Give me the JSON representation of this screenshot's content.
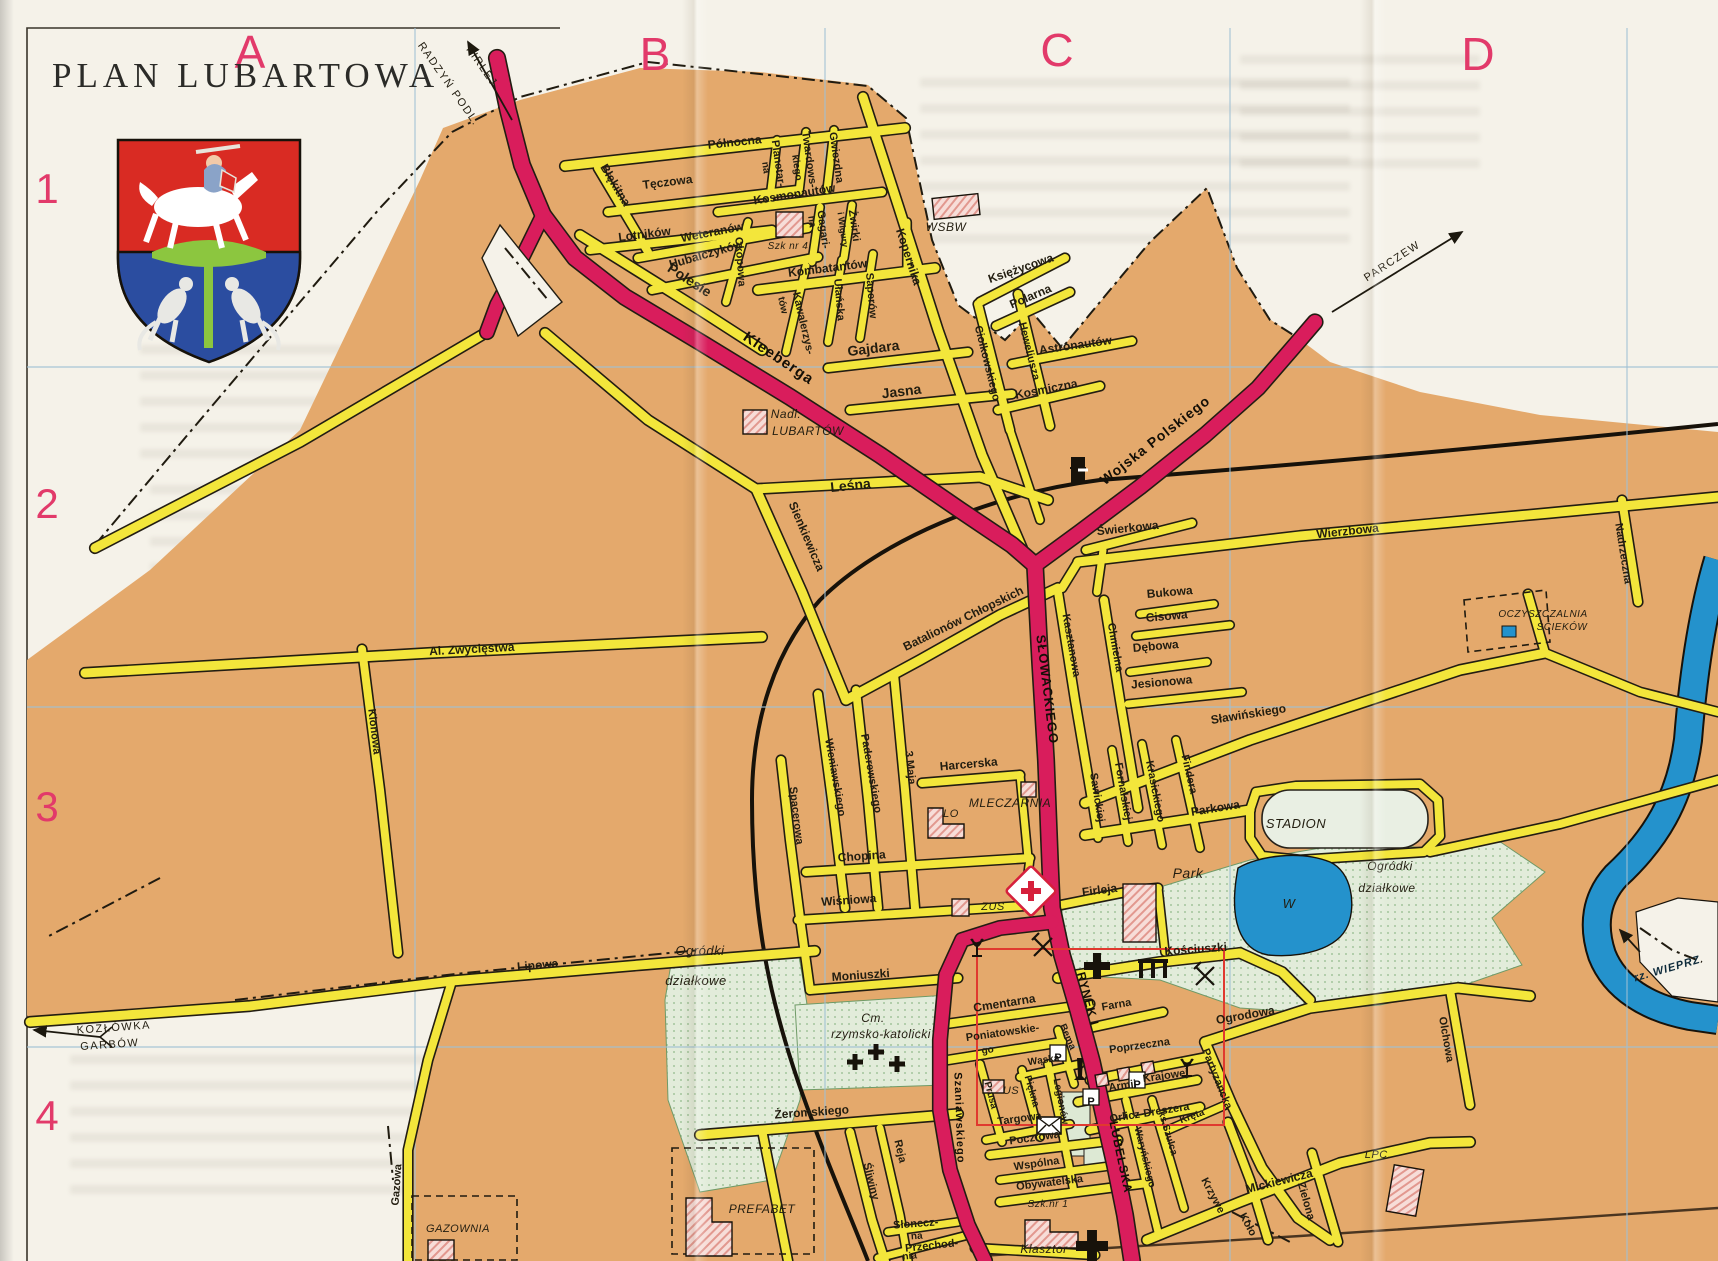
{
  "title": "PLAN LUBARTOWA",
  "grid": {
    "columns": [
      "A",
      "B",
      "C",
      "D"
    ],
    "rows": [
      "1",
      "2",
      "3",
      "4"
    ]
  },
  "colors": {
    "paper": "#f5f2e9",
    "urban_tan": "#e4a96c",
    "road_yellow": "#f3e63b",
    "road_major": "#d91d5c",
    "water": "#2492cc",
    "green_area": "#e2ecda",
    "grid_blue": "#9fc0d4",
    "grid_letter": "#e23a6a",
    "inset_red": "#e0392f",
    "building_pink": "#f7ddd8"
  },
  "map": {
    "labels": [
      {
        "t": "A",
        "x": 250,
        "y": 68,
        "c": "grid",
        "s": 46
      },
      {
        "t": "B",
        "x": 655,
        "y": 70,
        "c": "grid",
        "s": 46
      },
      {
        "t": "C",
        "x": 1057,
        "y": 66,
        "c": "grid",
        "s": 46
      },
      {
        "t": "D",
        "x": 1478,
        "y": 70,
        "c": "grid",
        "s": 46
      },
      {
        "t": "1",
        "x": 47,
        "y": 203,
        "c": "grid",
        "s": 42
      },
      {
        "t": "2",
        "x": 47,
        "y": 518,
        "c": "grid",
        "s": 42
      },
      {
        "t": "3",
        "x": 47,
        "y": 821,
        "c": "grid",
        "s": 42
      },
      {
        "t": "4",
        "x": 47,
        "y": 1130,
        "c": "grid",
        "s": 42
      },
      {
        "t": "RADZYŃ PODL.",
        "x": 446,
        "y": 86,
        "r": 55,
        "c": "dir",
        "s": 11
      },
      {
        "t": "FIRLEJ",
        "x": 479,
        "y": 68,
        "r": 55,
        "c": "dir",
        "s": 11
      },
      {
        "t": "PARCZEW",
        "x": 1394,
        "y": 264,
        "r": -33,
        "c": "dir",
        "s": 11
      },
      {
        "t": "KOZŁÓWKA",
        "x": 114,
        "y": 1031,
        "r": -4,
        "c": "dir",
        "s": 11
      },
      {
        "t": "GARBÓW",
        "x": 110,
        "y": 1048,
        "r": -4,
        "c": "dir",
        "s": 11
      },
      {
        "t": "rz. WIEPRZ",
        "x": 1668,
        "y": 972,
        "r": -16,
        "c": "wat",
        "s": 11
      },
      {
        "t": "Północna",
        "x": 735,
        "y": 146,
        "r": -6
      },
      {
        "t": "Błękitna",
        "x": 612,
        "y": 187,
        "r": 59
      },
      {
        "t": "Tęczowa",
        "x": 668,
        "y": 186,
        "r": -7
      },
      {
        "t": "Lotników",
        "x": 645,
        "y": 238,
        "r": -7
      },
      {
        "t": "Kosmonautów",
        "x": 795,
        "y": 198,
        "r": -9
      },
      {
        "t": "Planetar-",
        "x": 775,
        "y": 164,
        "r": 82,
        "s": 11
      },
      {
        "t": "na",
        "x": 763,
        "y": 168,
        "r": 82,
        "s": 10
      },
      {
        "t": "Twardows-",
        "x": 806,
        "y": 160,
        "r": 82,
        "s": 11
      },
      {
        "t": "kiego",
        "x": 794,
        "y": 168,
        "r": 82,
        "s": 10
      },
      {
        "t": "Gwiezdna",
        "x": 833,
        "y": 158,
        "r": 82,
        "s": 11
      },
      {
        "t": "Żwirki",
        "x": 851,
        "y": 226,
        "r": 82,
        "s": 11
      },
      {
        "t": "i Wigury",
        "x": 840,
        "y": 230,
        "r": 82,
        "s": 9
      },
      {
        "t": "Gagari-",
        "x": 820,
        "y": 230,
        "r": 82,
        "s": 11
      },
      {
        "t": "na",
        "x": 809,
        "y": 222,
        "r": 82,
        "s": 10
      },
      {
        "t": "Kopernika",
        "x": 905,
        "y": 258,
        "r": 72
      },
      {
        "t": "Okopowa",
        "x": 737,
        "y": 262,
        "r": 86,
        "s": 11
      },
      {
        "t": "Weteranów",
        "x": 713,
        "y": 236,
        "r": -11
      },
      {
        "t": "Hubalczyków",
        "x": 707,
        "y": 258,
        "r": -16
      },
      {
        "t": "Polesie",
        "x": 687,
        "y": 284,
        "r": 33,
        "s": 14
      },
      {
        "t": "Kawalerzys-",
        "x": 800,
        "y": 324,
        "r": 77,
        "s": 11
      },
      {
        "t": "tów",
        "x": 780,
        "y": 306,
        "r": 77,
        "s": 10
      },
      {
        "t": "Ułańska",
        "x": 836,
        "y": 300,
        "r": 85,
        "s": 11
      },
      {
        "t": "Saperów",
        "x": 868,
        "y": 296,
        "r": 85,
        "s": 11
      },
      {
        "t": "Kombatantów",
        "x": 828,
        "y": 272,
        "r": -7
      },
      {
        "t": "Gajdara",
        "x": 874,
        "y": 353,
        "r": -7,
        "s": 14
      },
      {
        "t": "Jasna",
        "x": 902,
        "y": 396,
        "r": -7,
        "s": 14
      },
      {
        "t": "Kleeberga",
        "x": 776,
        "y": 362,
        "r": 34,
        "s": 15,
        "c": "mj"
      },
      {
        "t": "Księżycowa",
        "x": 1022,
        "y": 272,
        "r": -19
      },
      {
        "t": "Polarna",
        "x": 1032,
        "y": 300,
        "r": -23
      },
      {
        "t": "Ciołkowskiego",
        "x": 984,
        "y": 364,
        "r": 76,
        "s": 11
      },
      {
        "t": "Heweliusza",
        "x": 1026,
        "y": 352,
        "r": 76,
        "s": 11
      },
      {
        "t": "Astronautów",
        "x": 1076,
        "y": 349,
        "r": -8
      },
      {
        "t": "Kosmiczna",
        "x": 1047,
        "y": 393,
        "r": -11
      },
      {
        "t": "Wojska Polskiego",
        "x": 1158,
        "y": 444,
        "r": -38,
        "s": 14,
        "c": "mj"
      },
      {
        "t": "Leśna",
        "x": 851,
        "y": 490,
        "r": -6,
        "s": 14
      },
      {
        "t": "Sienkiewicza",
        "x": 803,
        "y": 538,
        "r": 67
      },
      {
        "t": "Świerkowa",
        "x": 1128,
        "y": 532,
        "r": -6
      },
      {
        "t": "Wierzbowa",
        "x": 1348,
        "y": 535,
        "r": -6
      },
      {
        "t": "Nadrzeczna",
        "x": 1620,
        "y": 554,
        "r": 81,
        "s": 11
      },
      {
        "t": "Kasztanowa",
        "x": 1068,
        "y": 646,
        "r": 80,
        "s": 11
      },
      {
        "t": "Chmielna",
        "x": 1112,
        "y": 648,
        "r": 80,
        "s": 11
      },
      {
        "t": "Bukowa",
        "x": 1170,
        "y": 596,
        "r": -5
      },
      {
        "t": "Cisowa",
        "x": 1167,
        "y": 620,
        "r": -5
      },
      {
        "t": "Dębowa",
        "x": 1156,
        "y": 650,
        "r": -5
      },
      {
        "t": "Jesionowa",
        "x": 1162,
        "y": 686,
        "r": -5
      },
      {
        "t": "Sławińskiego",
        "x": 1249,
        "y": 718,
        "r": -9
      },
      {
        "t": "Batalionów Chłopskich",
        "x": 965,
        "y": 622,
        "r": -26
      },
      {
        "t": "SŁOWACKIEGO",
        "x": 1043,
        "y": 690,
        "r": 83,
        "s": 13,
        "c": "mj"
      },
      {
        "t": "Spacerowa",
        "x": 793,
        "y": 816,
        "r": 83,
        "s": 11
      },
      {
        "t": "Wieniawskiego",
        "x": 832,
        "y": 778,
        "r": 80,
        "s": 11
      },
      {
        "t": "Paderewskiego",
        "x": 868,
        "y": 774,
        "r": 80,
        "s": 11
      },
      {
        "t": "3 Maja",
        "x": 907,
        "y": 768,
        "r": 84,
        "s": 11
      },
      {
        "t": "Harcerska",
        "x": 969,
        "y": 768,
        "r": -5
      },
      {
        "t": "Chopina",
        "x": 862,
        "y": 860,
        "r": -4
      },
      {
        "t": "Wiśniowa",
        "x": 849,
        "y": 904,
        "r": -4
      },
      {
        "t": "Moniuszki",
        "x": 861,
        "y": 979,
        "r": -4
      },
      {
        "t": "Sawickiej",
        "x": 1094,
        "y": 798,
        "r": 81,
        "s": 11
      },
      {
        "t": "Fornalskiej",
        "x": 1120,
        "y": 792,
        "r": 80,
        "s": 11
      },
      {
        "t": "Krasickiego",
        "x": 1152,
        "y": 792,
        "r": 79,
        "s": 11
      },
      {
        "t": "Findera",
        "x": 1186,
        "y": 775,
        "r": 77,
        "s": 11
      },
      {
        "t": "Parkowa",
        "x": 1216,
        "y": 812,
        "r": -9
      },
      {
        "t": "Firleja",
        "x": 1100,
        "y": 894,
        "r": -7
      },
      {
        "t": "Kościuszki",
        "x": 1196,
        "y": 953,
        "r": -4
      },
      {
        "t": "Ogrodowa",
        "x": 1246,
        "y": 1019,
        "r": -10
      },
      {
        "t": "Olchowa",
        "x": 1443,
        "y": 1040,
        "r": 80,
        "s": 11
      },
      {
        "t": "Partyzancka",
        "x": 1214,
        "y": 1080,
        "r": 68,
        "s": 11
      },
      {
        "t": "Armii",
        "x": 1123,
        "y": 1089,
        "r": -8,
        "s": 11
      },
      {
        "t": "Krajowej",
        "x": 1166,
        "y": 1079,
        "r": -8,
        "s": 11
      },
      {
        "t": "Orlicz-Dreszera",
        "x": 1150,
        "y": 1116,
        "r": -9,
        "s": 11
      },
      {
        "t": "Poprzeczna",
        "x": 1140,
        "y": 1049,
        "r": -8,
        "s": 11
      },
      {
        "t": "Farna",
        "x": 1117,
        "y": 1008,
        "r": -10,
        "s": 11
      },
      {
        "t": "Bema",
        "x": 1065,
        "y": 1038,
        "r": 66,
        "s": 10
      },
      {
        "t": "RYNEK I",
        "x": 1084,
        "y": 1000,
        "r": 75,
        "s": 12,
        "c": "mj"
      },
      {
        "t": "LUBELSKA",
        "x": 1117,
        "y": 1158,
        "r": 78,
        "s": 12,
        "c": "mj"
      },
      {
        "t": "Szaniawskiego",
        "x": 956,
        "y": 1118,
        "r": 88,
        "s": 11,
        "c": "mj"
      },
      {
        "t": "Cmentarna",
        "x": 1005,
        "y": 1007,
        "r": -9
      },
      {
        "t": "Poniatowskie-",
        "x": 1003,
        "y": 1036,
        "r": -8,
        "s": 11
      },
      {
        "t": "go",
        "x": 988,
        "y": 1053,
        "r": -8,
        "s": 10
      },
      {
        "t": "Wąska",
        "x": 1044,
        "y": 1063,
        "r": -8,
        "s": 10
      },
      {
        "t": "Piękna",
        "x": 1029,
        "y": 1092,
        "r": 74,
        "s": 10
      },
      {
        "t": "Prusa",
        "x": 988,
        "y": 1096,
        "r": 75,
        "s": 10
      },
      {
        "t": "Legionów",
        "x": 1058,
        "y": 1102,
        "r": 79,
        "s": 10
      },
      {
        "t": "Targowa",
        "x": 1020,
        "y": 1122,
        "r": -8,
        "s": 11
      },
      {
        "t": "Pocztowa",
        "x": 1035,
        "y": 1141,
        "r": -8,
        "s": 11
      },
      {
        "t": "Wspólna",
        "x": 1037,
        "y": 1167,
        "r": -8,
        "s": 11
      },
      {
        "t": "Obywatelska",
        "x": 1050,
        "y": 1186,
        "r": -7,
        "s": 11
      },
      {
        "t": "Waryńskiego",
        "x": 1142,
        "y": 1158,
        "r": 76,
        "s": 10
      },
      {
        "t": "ks.Szulca",
        "x": 1165,
        "y": 1134,
        "r": 73,
        "s": 10
      },
      {
        "t": "Kręta",
        "x": 1193,
        "y": 1119,
        "r": -20,
        "s": 10
      },
      {
        "t": "Krzywe",
        "x": 1210,
        "y": 1197,
        "r": 62,
        "s": 11
      },
      {
        "t": "Koło",
        "x": 1245,
        "y": 1226,
        "r": 62,
        "s": 11
      },
      {
        "t": "Mickiewicza",
        "x": 1280,
        "y": 1185,
        "r": -14
      },
      {
        "t": "Zielona",
        "x": 1303,
        "y": 1202,
        "r": 74,
        "s": 11
      },
      {
        "t": "Żeromskiego",
        "x": 812,
        "y": 1116,
        "r": -4
      },
      {
        "t": "Reja",
        "x": 897,
        "y": 1152,
        "r": 77,
        "s": 11
      },
      {
        "t": "Śliwiny",
        "x": 868,
        "y": 1182,
        "r": 76,
        "s": 11
      },
      {
        "t": "Słonecz-",
        "x": 916,
        "y": 1227,
        "r": -4,
        "s": 11
      },
      {
        "t": "na",
        "x": 917,
        "y": 1239,
        "r": -4,
        "s": 10
      },
      {
        "t": "Przechod-",
        "x": 932,
        "y": 1249,
        "r": -6,
        "s": 11
      },
      {
        "t": "nia",
        "x": 910,
        "y": 1259,
        "r": -6,
        "s": 10
      },
      {
        "t": "Lipowa",
        "x": 538,
        "y": 969,
        "r": -5
      },
      {
        "t": "Al. Zwycięstwa",
        "x": 472,
        "y": 653,
        "r": -3
      },
      {
        "t": "Klonowa",
        "x": 371,
        "y": 732,
        "r": 83,
        "s": 11
      },
      {
        "t": "Gazowa",
        "x": 400,
        "y": 1185,
        "r": -86,
        "s": 11
      },
      {
        "t": "WSBW",
        "x": 946,
        "y": 231,
        "c": "pl",
        "s": 12
      },
      {
        "t": "Nadl.",
        "x": 786,
        "y": 418,
        "c": "pl",
        "s": 12
      },
      {
        "t": "LUBARTÓW",
        "x": 808,
        "y": 435,
        "c": "pl",
        "s": 12
      },
      {
        "t": "Szk nr 4",
        "x": 788,
        "y": 249,
        "c": "pl",
        "s": 10
      },
      {
        "t": "MLECZARNIA",
        "x": 1010,
        "y": 807,
        "c": "pl",
        "s": 12
      },
      {
        "t": "LO",
        "x": 951,
        "y": 817,
        "c": "pl",
        "s": 11
      },
      {
        "t": "ZUS",
        "x": 993,
        "y": 910,
        "c": "pl",
        "s": 11
      },
      {
        "t": "STADION",
        "x": 1296,
        "y": 828,
        "c": "pl",
        "s": 13
      },
      {
        "t": "Park",
        "x": 1188,
        "y": 878,
        "c": "pl",
        "s": 14
      },
      {
        "t": "W",
        "x": 1289,
        "y": 908,
        "c": "pl",
        "s": 13
      },
      {
        "t": "Ogródki",
        "x": 700,
        "y": 955,
        "c": "pl",
        "s": 13
      },
      {
        "t": "działkowe",
        "x": 696,
        "y": 985,
        "c": "pl",
        "s": 13
      },
      {
        "t": "Ogródki",
        "x": 1390,
        "y": 870,
        "c": "pl",
        "s": 12
      },
      {
        "t": "działkowe",
        "x": 1387,
        "y": 892,
        "c": "pl",
        "s": 12
      },
      {
        "t": "Cm.",
        "x": 873,
        "y": 1022,
        "c": "pl",
        "s": 12
      },
      {
        "t": "rzymsko-katolicki",
        "x": 881,
        "y": 1038,
        "c": "pl",
        "s": 12
      },
      {
        "t": "OCZYSZCZALNIA",
        "x": 1543,
        "y": 617,
        "c": "pl",
        "s": 10
      },
      {
        "t": "ŚCIEKÓW",
        "x": 1562,
        "y": 630,
        "c": "pl",
        "s": 10
      },
      {
        "t": "GAZOWNIA",
        "x": 458,
        "y": 1232,
        "c": "pl",
        "s": 11
      },
      {
        "t": "PREFABET",
        "x": 762,
        "y": 1213,
        "c": "pl",
        "s": 12
      },
      {
        "t": "Szk.nr 1",
        "x": 1048,
        "y": 1207,
        "c": "pl",
        "s": 10
      },
      {
        "t": "Klasztor",
        "x": 1044,
        "y": 1253,
        "c": "pl",
        "s": 12
      },
      {
        "t": "LPC.",
        "x": 1378,
        "y": 1158,
        "c": "pl",
        "s": 11
      },
      {
        "t": "US",
        "x": 1011,
        "y": 1094,
        "c": "pl",
        "s": 11
      },
      {
        "t": "P",
        "x": 1058,
        "y": 1061,
        "c": "bdg",
        "s": 11
      },
      {
        "t": "P",
        "x": 1137,
        "y": 1088,
        "c": "bdg",
        "s": 11
      },
      {
        "t": "P",
        "x": 1091,
        "y": 1105,
        "c": "bdg",
        "s": 11
      }
    ]
  }
}
